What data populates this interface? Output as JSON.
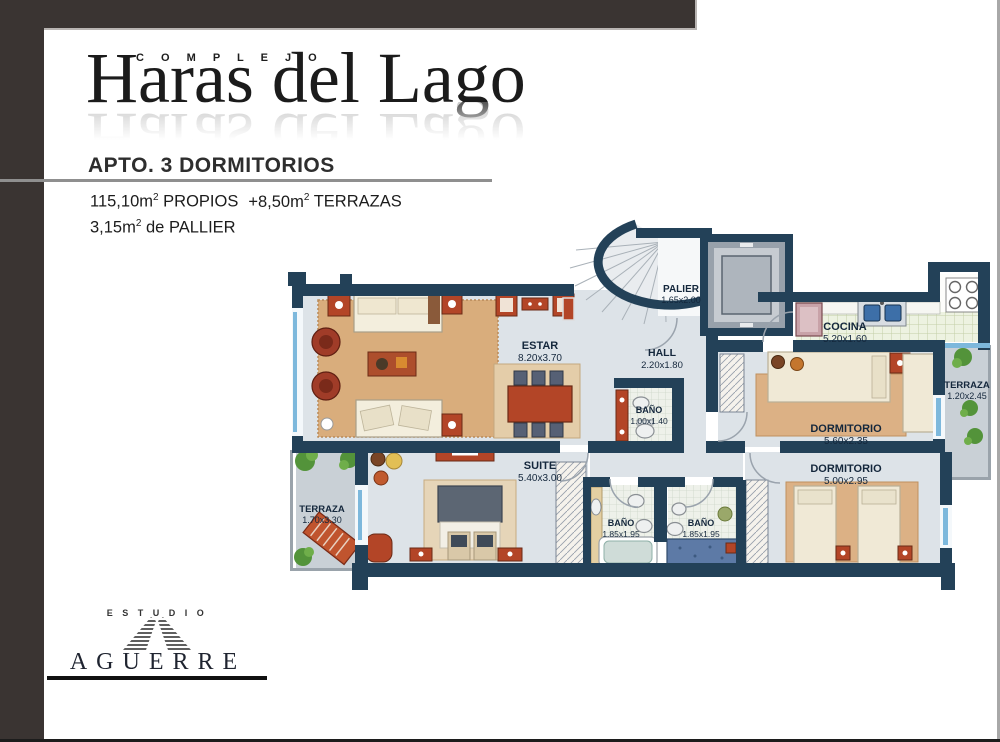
{
  "brand": {
    "kicker": "C O M P L E J O",
    "title": "Haras del Lago"
  },
  "header": {
    "title": "APTO. 3 DORMITORIOS",
    "area1_value": "115,10m",
    "area1_sup": "2",
    "area1_label": " PROPIOS",
    "area2_value": "+8,50m",
    "area2_sup": "2",
    "area2_label": " TERRAZAS",
    "area3_value": "3,15m",
    "area3_sup": "2",
    "area3_label": " de PALLIER"
  },
  "rooms": {
    "palier": {
      "name": "PALIER",
      "dims": "1.65x2.00"
    },
    "estar": {
      "name": "ESTAR",
      "dims": "8.20x3.70"
    },
    "hall": {
      "name": "HALL",
      "dims": "2.20x1.80"
    },
    "cocina": {
      "name": "COCINA",
      "dims": "5.20x1.60"
    },
    "terraza_este": {
      "name": "TERRAZA",
      "dims": "1.20x2.45"
    },
    "dormitorio_1": {
      "name": "DORMITORIO",
      "dims": "5.60x2.35"
    },
    "dormitorio_2": {
      "name": "DORMITORIO",
      "dims": "5.00x2.95"
    },
    "banio_hall": {
      "name": "BAÑO",
      "dims": "1.00x1.40"
    },
    "suite": {
      "name": "SUITE",
      "dims": "5.40x3.00"
    },
    "terraza_oeste": {
      "name": "TERRAZA",
      "dims": "1.70x3.30"
    },
    "banio_suite": {
      "name": "BAÑO",
      "dims": "1.85x1.95"
    },
    "banio_2": {
      "name": "BAÑO",
      "dims": "1.85x1.95"
    }
  },
  "footer": {
    "studio": "E S T U D I O",
    "name": "AGUERRE"
  },
  "colors": {
    "wall": "#234158",
    "accent_red": "#b34527",
    "floor": "#dde3e8",
    "frame": "#3a3432"
  }
}
